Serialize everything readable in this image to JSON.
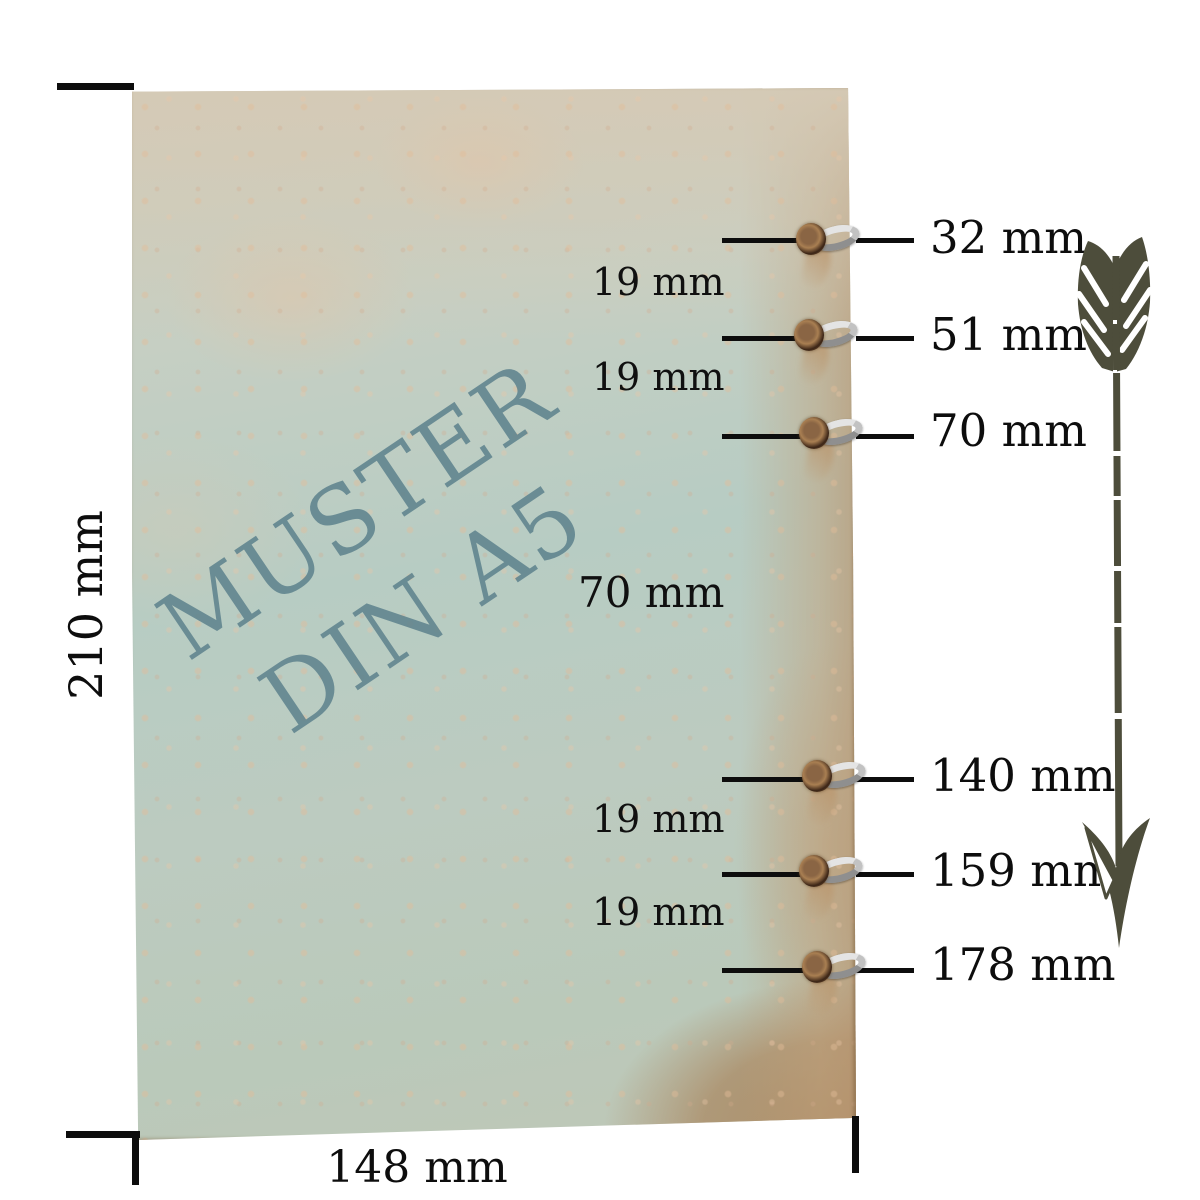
{
  "watermark": {
    "line1": "MUSTER",
    "line2": "DIN A5"
  },
  "sheet": {
    "height_label": "210 mm",
    "width_label": "148 mm"
  },
  "holes": [
    {
      "label": "32 mm"
    },
    {
      "label": "51 mm"
    },
    {
      "label": "70 mm"
    },
    {
      "label": "140 mm"
    },
    {
      "label": "159 mm"
    },
    {
      "label": "178 mm"
    }
  ],
  "spacings": [
    {
      "label": "19 mm"
    },
    {
      "label": "19 mm"
    },
    {
      "label": "70 mm"
    },
    {
      "label": "19 mm"
    },
    {
      "label": "19 mm"
    }
  ],
  "colors": {
    "paper_green": "#b7ccc2",
    "paper_beige": "#d5cab6",
    "paper_tan": "#ab8d68",
    "watermark": "#5e838d",
    "arrow": "#4d4d3b",
    "dimension_line": "#0d0d0d"
  }
}
